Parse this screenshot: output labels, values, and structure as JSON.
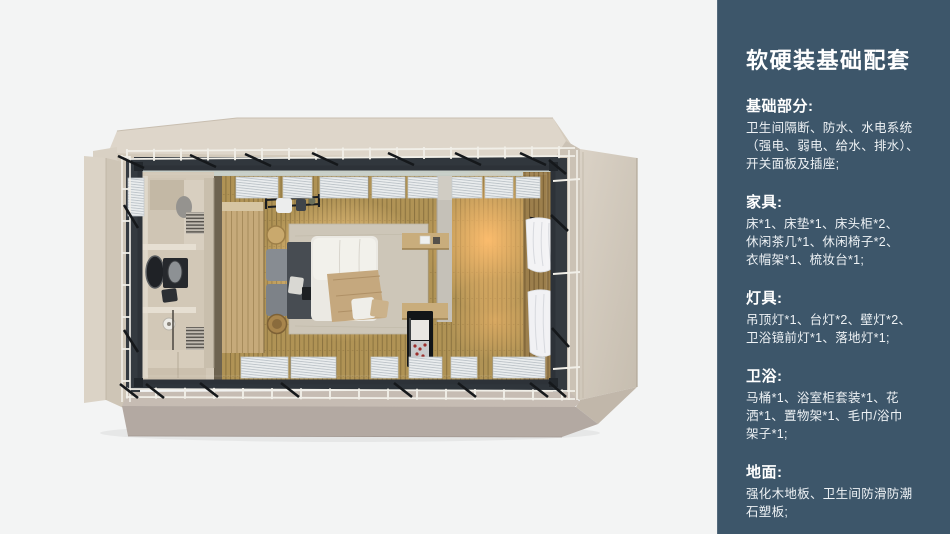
{
  "page": {
    "background": "#f3f4f4"
  },
  "sidebar": {
    "background": "#3d566a",
    "text_color": "#ffffff",
    "title": "软硬装基础配套",
    "sections": [
      {
        "heading": "基础部分:",
        "body": "卫生间隔断、防水、水电系统\n（强电、弱电、给水、排水）、\n开关面板及插座;"
      },
      {
        "heading": "家具:",
        "body": "床*1、床垫*1、床头柜*2、\n休闲茶几*1、休闲椅子*2、\n衣帽架*1、梳妆台*1;"
      },
      {
        "heading": "灯具:",
        "body": "吊顶灯*1、台灯*2、壁灯*2、\n卫浴镜前灯*1、落地灯*1;"
      },
      {
        "heading": "卫浴:",
        "body": "马桶*1、浴室柜套装*1、花\n洒*1、置物架*1、毛巾/浴巾\n架子*1;"
      },
      {
        "heading": "地面:",
        "body": "强化木地板、卫生间防滑防潮\n石塑板;"
      }
    ]
  },
  "floorplan": {
    "palette": {
      "shell_beige": "#d8cfc2",
      "steel_frame": "#2e343a",
      "floor_wood": "#b09355",
      "glass": "#c0c7c1",
      "blind_white": "#eaedee",
      "wardrobe_wood": "#c6aa7a",
      "bathroom_beige": "#d2c8b7",
      "bed_linen": "#ebe9e3",
      "headboard_gray": "#474c52",
      "rug": "#cdc6b8",
      "curtain_white": "#f3f3f5",
      "lamp_glow": "#ffc87e"
    }
  }
}
